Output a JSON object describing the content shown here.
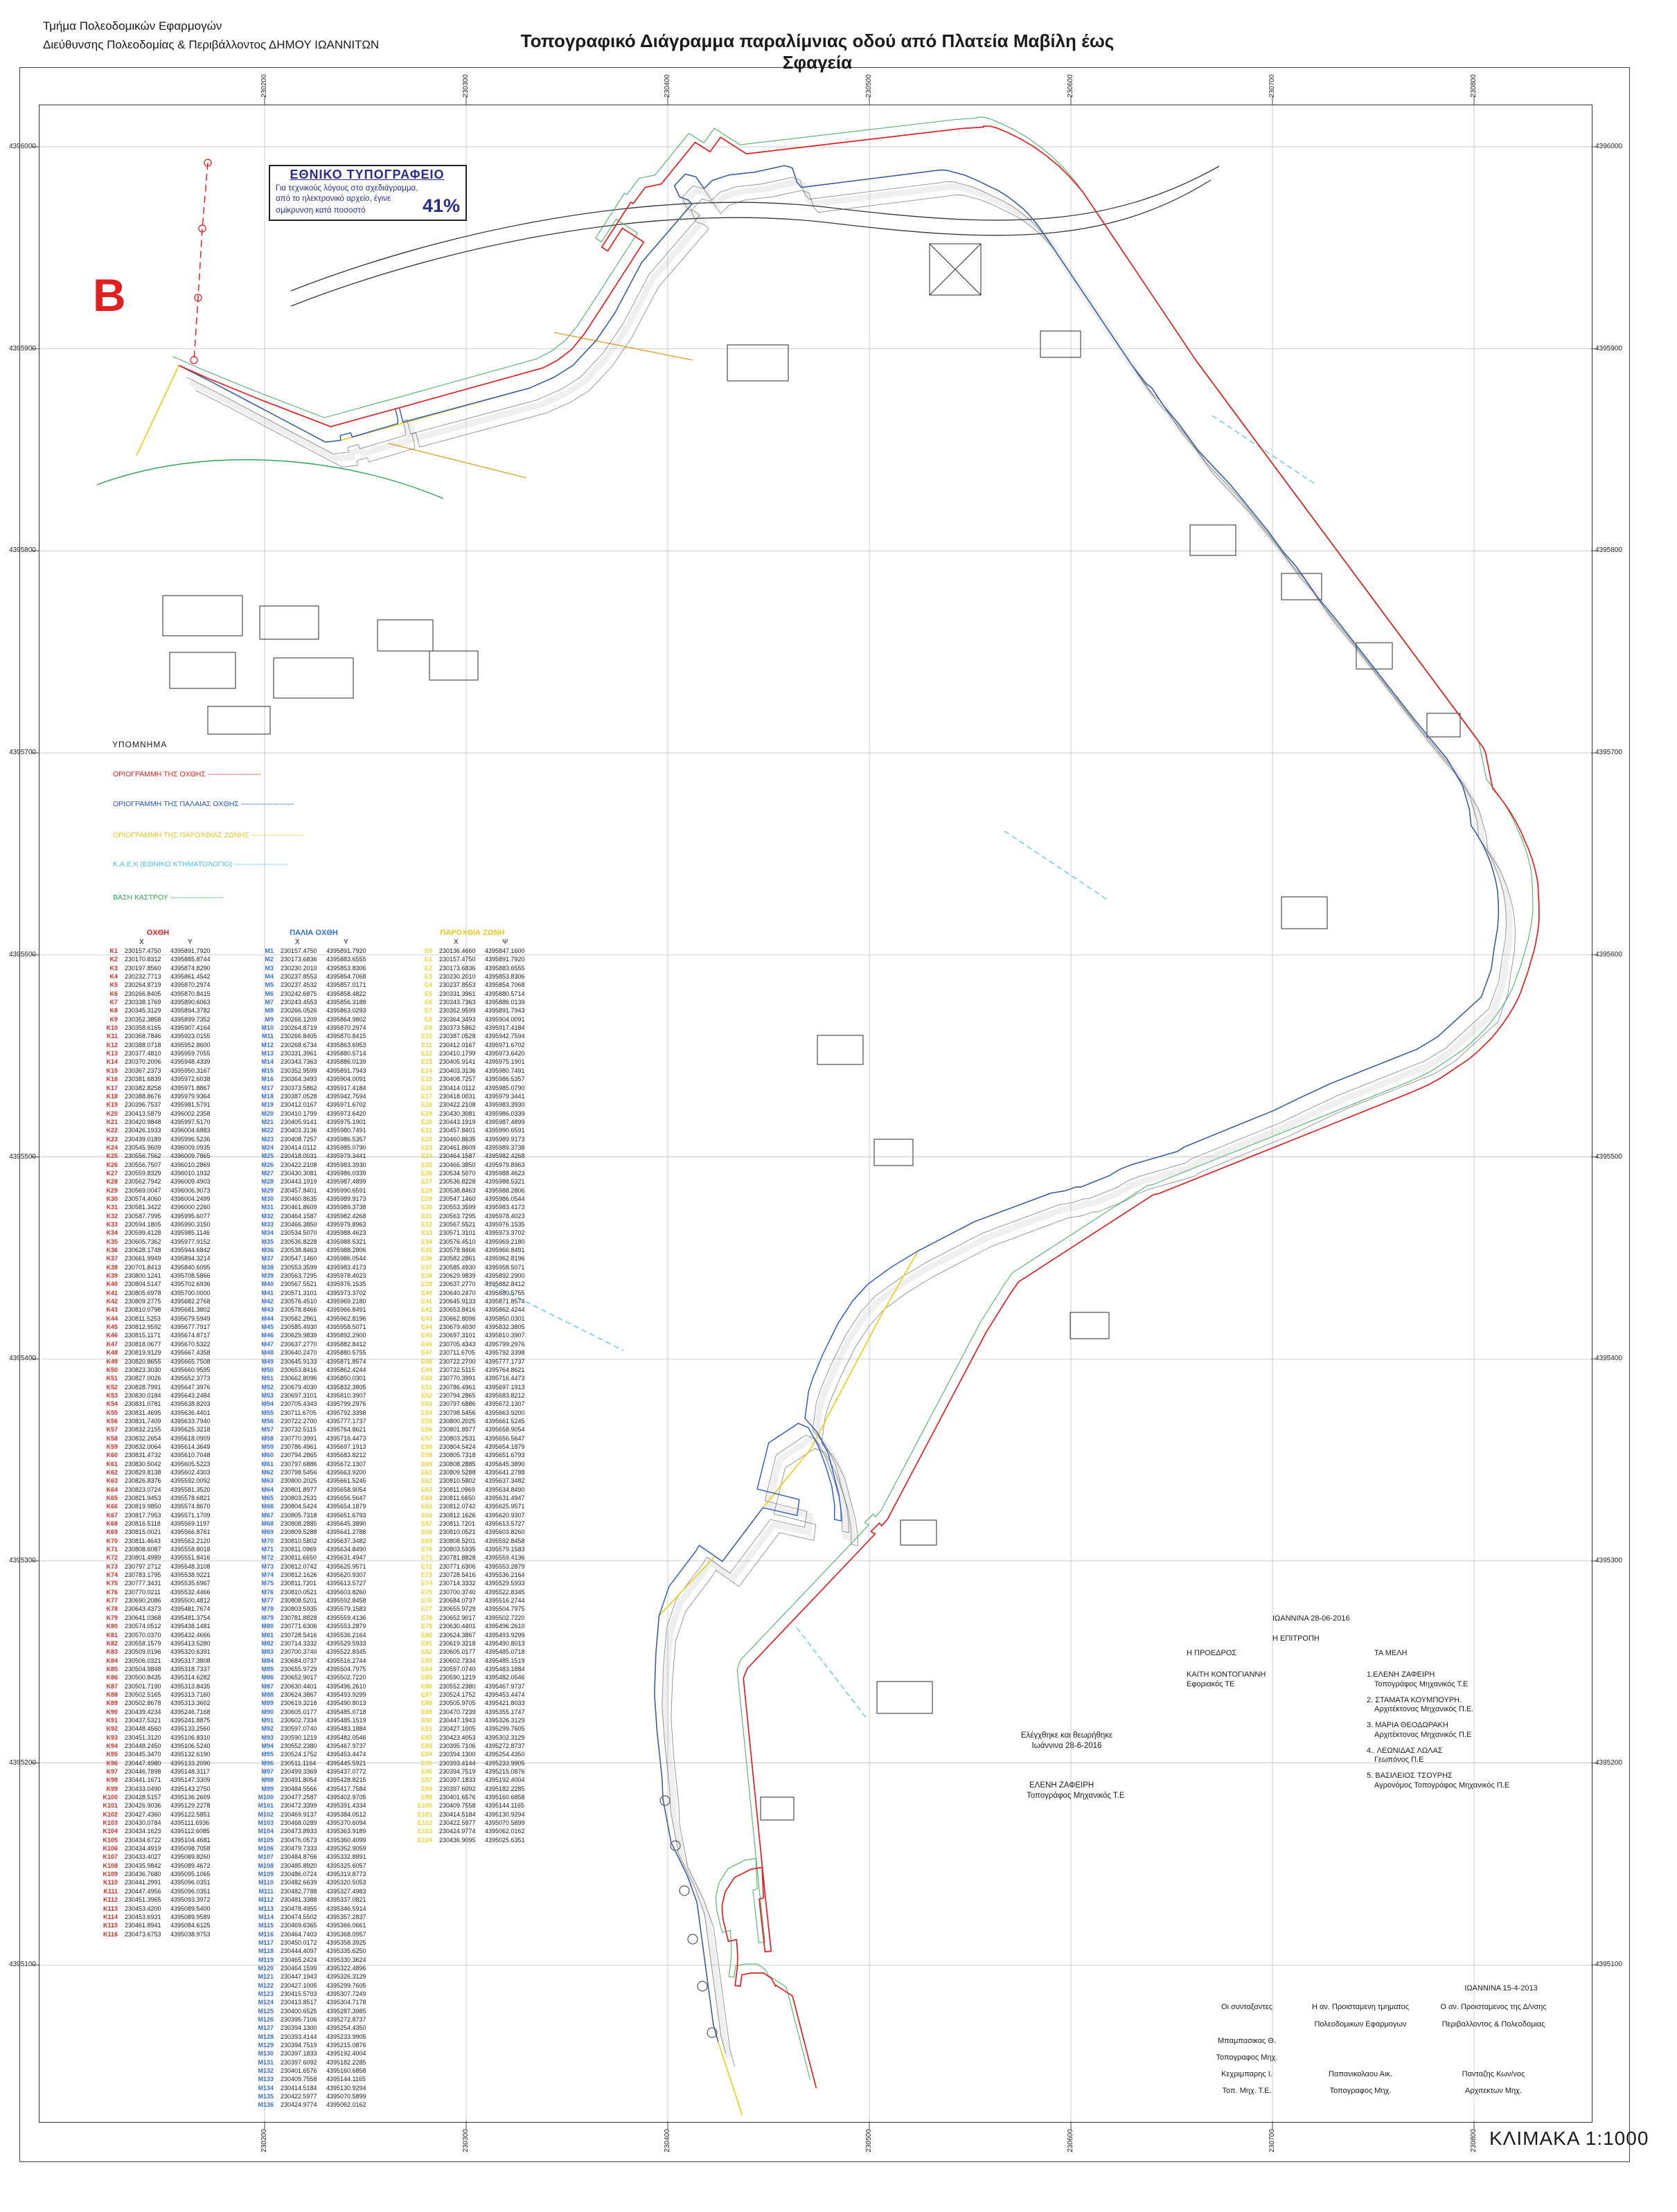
{
  "page": {
    "header_line1": "Τμήμα Πολεοδομικών Εφαρμογών",
    "header_line2": "Διεύθυνσης Πολεοδομίας & Περιβάλλοντος ΔΗΜΟΥ ΙΩΑΝΝΙΤΩΝ",
    "title": "Τοπογραφικό Διάγραμμα παραλίμνιας οδού από Πλατεία Μαβίλη έως Σφαγεία",
    "marker": "B",
    "scale_label": "ΚΛΙΜΑΚΑ 1:1000"
  },
  "reduction_box": {
    "title": "ΕΘΝΙΚΟ ΤΥΠΟΓΡΑΦΕΙΟ",
    "line1": "Για τεχνικούς λόγους στο σχεδιάγραμμα,",
    "line2": "από το ηλεκτρονικό αρχείο, έγινε",
    "line3": "σμίκρυνση κατά ποσοστό",
    "value": "41%"
  },
  "legend": {
    "title": "ΥΠΟΜΝΗΜΑ",
    "items": [
      {
        "label": "ΟΡΙΟΓΡΑΜΜΗ ΤΗΣ ΟΧΘΗΣ",
        "color": "#e02020"
      },
      {
        "label": "ΟΡΙΟΓΡΑΜΜΗ ΤΗΣ ΠΑΛΑΙΑΣ ΟΧΘΗΣ",
        "color": "#2456c8"
      },
      {
        "label": "ΟΡΙΟΓΡΑΜΜΗ ΤΗΣ ΠΑΡΟΧΘΙΑΣ ΖΩΝΗΣ",
        "color": "#e8c51d"
      },
      {
        "label": "Κ.Α.Ε.Κ (ΕΘΝΙΚΟ ΚΤΗΜΑΤΟΛΟΓΙΟ)",
        "color": "#45c0ee"
      },
      {
        "label": "ΒΑΣΗ ΚΑΣΤΡΟΥ",
        "color": "#2ea44f"
      }
    ]
  },
  "grid": {
    "x_labels": [
      "230200",
      "230300",
      "230400",
      "230500",
      "230600",
      "230700",
      "230800"
    ],
    "y_labels": [
      "4396000",
      "4395900",
      "4395800",
      "4395700",
      "4395600",
      "4395500",
      "4395400",
      "4395300",
      "4395200",
      "4395100"
    ]
  },
  "tables": [
    {
      "title": "ΟΧΘΗ",
      "x_header": "X",
      "y_header": "Y",
      "title_color": "#e02020",
      "label_color": "#d03028",
      "line_color": "#e02020",
      "rows": [
        "K1 230157.4750 4395891.7920",
        "K2 230170.8312 4395885.8744",
        "K3 230197.8560 4395874.8290",
        "K4 230232.7713 4395861.4542",
        "K5 230264.8719 4395870.2974",
        "K6 230266.8405 4395870.8415",
        "K7 230338.1769 4395890.6063",
        "K8 230345.3129 4395894.3782",
        "K9 230352.3858 4395899.7352",
        "K10 230358.6165 4395907.4164",
        "K11 230368.7846 4395923.0155",
        "K12 230388.0718 4395952.8600",
        "K13 230377.4810 4395959.7055",
        "K14 230370.2006 4395948.4339",
        "K15 230367.2373 4395950.3167",
        "K16 230381.6839 4395972.6038",
        "K17 230382.8258 4395971.8867",
        "K18 230388.8676 4395979.9364",
        "K19 230396.7537 4395981.5791",
        "K20 230413.5879 4396002.2358",
        "K21 230420.9848 4395997.5170",
        "K22 230426.1933 4396004.6883",
        "K23 230439.0189 4395996.5236",
        "K24 230545.9609 4396009.0935",
        "K25 230556.7562 4396009.7865",
        "K26 230556.7507 4396010.2869",
        "K27 230559.8329 4396010.1932",
        "K28 230562.7942 4396009.4903",
        "K29 230569.0047 4396006.9073",
        "K30 230574.4060 4396004.2499",
        "K31 230581.3422 4396000.2260",
        "K32 230587.7995 4395995.6077",
        "K33 230594.1805 4395990.3150",
        "K34 230599.4128 4395985.1146",
        "K35 230605.7362 4395977.9152",
        "K36 230628.1748 4395944.6842",
        "K37 230661.9949 4395894.3214",
        "K38 230701.8413 4395840.6095",
        "K39 230800.1241 4395708.5866",
        "K40 230804.5147 4395702.6936",
        "K41 230805.6978 4395700.0000",
        "K42 230809.2775 4395682.2768",
        "K43 230810.0798 4395681.3802",
        "K44 230811.5253 4395679.5949",
        "K45 230812.9592 4395677.7917",
        "K46 230815.1171 4395674.8717",
        "K47 230818.0677 4395670.5322",
        "K48 230819.9129 4395667.4358",
        "K49 230820.8655 4395665.7508",
        "K50 230823.3030 4395660.9595",
        "K51 230827.0026 4395652.3773",
        "K52 230828.7991 4395647.3976",
        "K53 230830.0184 4395643.2484",
        "K54 230831.0781 4395638.8203",
        "K55 230831.4695 4395636.4401",
        "K56 230831.7409 4395633.7940",
        "K57 230832.2155 4395625.3218",
        "K58 230832.2654 4395618.0909",
        "K59 230832.0064 4395614.3649",
        "K60 230831.4732 4395610.7048",
        "K61 230830.5042 4395605.5223",
        "K62 230829.8138 4395602.4303",
        "K63 230826.8376 4395592.0092",
        "K64 230823.0724 4395581.3520",
        "K65 230821.9453 4395578.6821",
        "K66 230819.9850 4395574.8670",
        "K67 230817.7953 4395571.1709",
        "K68 230816.5118 4395569.1197",
        "K69 230815.0021 4395566.8761",
        "K70 230811.4643 4395562.2120",
        "K71 230808.6087 4395558.8018",
        "K72 230801.4989 4395551.8416",
        "K73 230797.2712 4395548.3108",
        "K74 230783.1795 4395538.9221",
        "K75 230777.3431 4395535.6967",
        "K76 230770.0211 4395532.4466",
        "K77 230690.2086 4395500.4812",
        "K78 230643.4373 4395481.7674",
        "K79 230641.0368 4395481.3754",
        "K80 230574.0512 4395438.1481",
        "K81 230570.0370 4395432.4666",
        "K82 230558.1579 4395413.5280",
        "K83 230509.0196 4395320.6391",
        "K84 230506.0321 4395317.3808",
        "K85 230504.9848 4395318.7337",
        "K86 230500.8435 4395314.6282",
        "K87 230501.7190 4395313.8435",
        "K88 230502.5165 4395313.7160",
        "K89 230502.8678 4395313.3602",
        "K90 230439.4234 4395246.7168",
        "K91 230437.5321 4395241.8875",
        "K92 230448.4560 4395133.2560",
        "K93 230451.3120 4395106.8310",
        "K94 230448.2450 4395106.5240",
        "K95 230445.3470 4395132.6190",
        "K96 230447.4980 4395133.2090",
        "K97 230446.7898 4395148.3117",
        "K98 230441.1671 4395147.3309",
        "K99 230433.0490 4395143.2750",
        "K100 230428.5157 4395136.2609",
        "K101 230426.9036 4395129.2278",
        "K102 230427.4360 4395122.5851",
        "K103 230430.0784 4395111.6936",
        "K104 230434.1623 4395112.6085",
        "K105 230434.6722 4395104.4681",
        "K106 230434.4919 4395098.7058",
        "K107 230433.4027 4395089.8260",
        "K108 230435.9842 4395089.4672",
        "K109 230436.7680 4395095.1065",
        "K110 230441.2991 4395096.0351",
        "K111 230447.4956 4395096.0351",
        "K112 230451.3965 4395093.3972",
        "K113 230453.4200 4395089.5400",
        "K114 230453.6931 4395089.9589",
        "K115 230461.8941 4395084.6125",
        "K116 230473.6753 4395038.9753"
      ]
    },
    {
      "title": "ΠΑΛΙΑ ΟΧΘΗ",
      "x_header": "X",
      "y_header": "Y",
      "title_color": "#2e6bd0",
      "label_color": "#3a6fc8",
      "line_color": "#2456c8",
      "rows": [
        "M1 230157.4750 4395891.7920",
        "M2 230173.6836 4395883.6555",
        "M3 230230.2010 4395853.8306",
        "M4 230237.8553 4395854.7068",
        "M5 230237.4532 4395857.0171",
        "M6 230242.6875 4395858.4822",
        "M7 230243.4553 4395856.3188",
        "M8 230266.0526 4395863.0293",
        "M9 230266.1209 4395864.9802",
        "M10 230264.8719 4395870.2974",
        "M11 230266.8405 4395870.8415",
        "M12 230268.6734 4395863.6953",
        "M13 230331.3961 4395880.5714",
        "M14 230343.7363 4395886.0139",
        "M15 230352.9599 4395891.7943",
        "M16 230364.3493 4395904.0091",
        "M17 230373.5862 4395917.4184",
        "M18 230387.0528 4395942.7594",
        "M19 230412.0167 4395971.6702",
        "M20 230410.1799 4395973.6420",
        "M21 230405.9141 4395975.1901",
        "M22 230403.3136 4395980.7491",
        "M23 230408.7257 4395986.5357",
        "M24 230414.0112 4395985.0790",
        "M25 230418.0031 4395979.3441",
        "M26 230422.2108 4395983.3930",
        "M27 230430.3081 4395986.0339",
        "M28 230443.1919 4395987.4899",
        "M29 230457.8401 4395990.6591",
        "M30 230460.8635 4395989.9173",
        "M31 230461.8609 4395989.3738",
        "M32 230464.1587 4395982.4268",
        "M33 230466.3850 4395979.8963",
        "M34 230534.5070 4395988.4623",
        "M35 230536.8228 4395988.5321",
        "M36 230538.8463 4395988.2806",
        "M37 230547.1460 4395986.0544",
        "M38 230553.3599 4395983.4173",
        "M39 230563.7295 4395978.4023",
        "M40 230567.5521 4395976.1535",
        "M41 230571.3101 4395973.3702",
        "M42 230576.4510 4395969.2180",
        "M43 230578.8466 4395966.8491",
        "M44 230582.2861 4395962.8196",
        "M45 230585.4930 4395958.5071",
        "M46 230629.9839 4395892.2900",
        "M47 230637.2770 4395882.8412",
        "M48 230640.2470 4395880.5755",
        "M49 230645.9133 4395871.8574",
        "M50 230653.8416 4395862.4244",
        "M51 230662.8096 4395850.0301",
        "M52 230679.4030 4395832.3805",
        "M53 230697.3101 4395810.3907",
        "M54 230705.4343 4395799.2976",
        "M55 230711.6705 4395792.3398",
        "M56 230722.2700 4395777.1737",
        "M57 230732.5115 4395764.8621",
        "M58 230770.3991 4395716.4473",
        "M59 230786.4961 4395697.1913",
        "M60 230794.2865 4395683.8212",
        "M61 230797.6886 4395672.1307",
        "M62 230798.5456 4395663.9200",
        "M63 230800.2025 4395661.5245",
        "M64 230801.8977 4395658.9054",
        "M65 230803.2531 4395656.5647",
        "M66 230804.5424 4395654.1879",
        "M67 230805.7318 4395651.6793",
        "M68 230808.2885 4395645.3890",
        "M69 230809.5288 4395641.2788",
        "M70 230810.5802 4395637.3482",
        "M71 230811.0969 4395634.8490",
        "M72 230811.6650 4395631.4947",
        "M73 230812.0742 4395625.9571",
        "M74 230812.1626 4395620.9307",
        "M75 230811.7201 4395613.5727",
        "M76 230810.0521 4395603.8260",
        "M77 230808.5201 4395592.8458",
        "M78 230803.5935 4395579.1583",
        "M79 230781.8828 4395559.4136",
        "M80 230771.6306 4395553.2879",
        "M81 230728.5416 4395536.2164",
        "M82 230714.3332 4395529.5933",
        "M83 230700.3740 4395522.8345",
        "M84 230684.0737 4395516.2744",
        "M85 230655.9729 4395504.7975",
        "M86 230652.9017 4395502.7220",
        "M87 230630.4401 4395496.2610",
        "M88 230624.3867 4395493.9299",
        "M89 230619.3218 4395490.8013",
        "M90 230605.0177 4395485.0718",
        "M91 230602.7334 4395485.1519",
        "M92 230597.0740 4395483.1884",
        "M93 230590.1219 4395482.0546",
        "M94 230552.2380 4395467.9737",
        "M95 230524.1752 4395453.4474",
        "M96 230511.1164 4395445.5921",
        "M97 230499.3369 4395437.0772",
        "M98 230491.8054 4395428.8215",
        "M99 230484.5566 4395417.7584",
        "M100 230477.2587 4395402.9705",
        "M101 230472.3399 4395391.4334",
        "M102 230469.9137 4395384.0512",
        "M103 230468.0289 4395370.6094",
        "M104 230473.8933 4395363.9189",
        "M105 230476.0573 4395360.4099",
        "M106 230479.7333 4395352.9059",
        "M107 230484.8766 4395332.8891",
        "M108 230485.8920 4395325.6057",
        "M109 230486.0724 4395319.8773",
        "M110 230482.6639 4395320.5053",
        "M111 230482.7788 4395327.4983",
        "M112 230481.3388 4395337.0821",
        "M113 230478.4955 4395346.5914",
        "M114 230474.5502 4395357.2837",
        "M115 230469.6365 4395366.0661",
        "M116 230464.7403 4395368.0957",
        "M117 230450.0172 4395358.3925",
        "M118 230444.4097 4395335.6250",
        "M119 230465.2424 4395330.3624",
        "M120 230464.1599 4395322.4896",
        "M121 230447.1943 4395326.3129",
        "M122 230427.1005 4395299.7605",
        "M123 230415.5703 4395307.7249",
        "M124 230413.8517 4395304.7178",
        "M125 230400.6525 4395287.3985",
        "M126 230395.7106 4395272.8737",
        "M127 230394.1300 4395254.4350",
        "M128 230393.4144 4395233.9905",
        "M129 230394.7519 4395215.0876",
        "M130 230397.1833 4395192.4004",
        "M131 230397.6092 4395182.2285",
        "M132 230401.6576 4395160.6858",
        "M133 230409.7558 4395144.1165",
        "M134 230414.5184 4395130.9294",
        "M135 230422.5977 4395070.5899",
        "M136 230424.9774 4395062.0162"
      ]
    },
    {
      "title": "ΠΑΡΟΧΘΙΑ ΖΩΝΗ",
      "x_header": "X",
      "y_header": "Ψ",
      "title_color": "#e3cb1a",
      "label_color": "#e8d435",
      "line_color": "#e8d22a",
      "rows": [
        "Ε0 230136.4660 4395847.1600",
        "Ε1 230157.4750 4395891.7920",
        "Ε2 230173.6836 4395883.6555",
        "Ε3 230230.2010 4395853.8306",
        "Ε4 230237.8553 4395854.7068",
        "Ε5 230331.3961 4395880.5714",
        "Ε6 230343.7363 4395886.0139",
        "Ε7 230352.9599 4395891.7943",
        "Ε8 230364.3493 4395904.0091",
        "Ε9 230373.5862 4395917.4184",
        "Ε10 230387.0528 4395942.7594",
        "Ε11 230412.0167 4395971.6702",
        "Ε12 230410.1799 4395973.6420",
        "Ε13 230405.9141 4395975.1901",
        "Ε14 230403.3136 4395980.7491",
        "Ε15 230408.7257 4395986.5357",
        "Ε16 230414.0112 4395985.0790",
        "Ε17 230418.0031 4395979.3441",
        "Ε18 230422.2108 4395983.3930",
        "Ε19 230430.3081 4395986.0339",
        "Ε20 230443.1919 4395987.4899",
        "Ε21 230457.8401 4395990.6591",
        "Ε22 230460.8635 4395989.9173",
        "Ε23 230461.8609 4395989.3738",
        "Ε24 230464.1587 4395982.4268",
        "Ε25 230466.3850 4395979.8963",
        "Ε26 230534.5070 4395988.4623",
        "Ε27 230536.8228 4395988.5321",
        "Ε28 230538.8463 4395988.2806",
        "Ε29 230547.1460 4395986.0544",
        "Ε30 230553.3599 4395983.4173",
        "Ε31 230563.7295 4395978.4023",
        "Ε32 230567.5521 4395976.1535",
        "Ε33 230571.3101 4395973.3702",
        "Ε34 230576.4510 4395969.2180",
        "Ε35 230578.8466 4395966.8491",
        "Ε36 230582.2861 4395962.8196",
        "Ε37 230585.4930 4395958.5071",
        "Ε38 230629.9839 4395892.2900",
        "Ε39 230637.2770 4395882.8412",
        "Ε40 230640.2470 4395880.5755",
        "Ε41 230645.9133 4395871.8574",
        "Ε42 230653.8416 4395862.4244",
        "Ε43 230662.8096 4395850.0301",
        "Ε44 230679.4030 4395832.3805",
        "Ε45 230697.3101 4395810.3907",
        "Ε46 230705.4343 4395799.2976",
        "Ε47 230711.6705 4395792.3398",
        "Ε48 230722.2700 4395777.1737",
        "Ε49 230732.5115 4395764.8621",
        "Ε50 230770.3991 4395716.4473",
        "Ε51 230786.4961 4395697.1913",
        "Ε52 230794.2865 4395683.8212",
        "Ε53 230797.6886 4395672.1307",
        "Ε54 230798.5456 4395663.9200",
        "Ε55 230800.2025 4395661.5245",
        "Ε56 230801.8977 4395658.9054",
        "Ε57 230803.2531 4395656.5647",
        "Ε58 230804.5424 4395654.1879",
        "Ε59 230805.7318 4395651.6793",
        "Ε60 230808.2885 4395645.3890",
        "Ε61 230809.5288 4395641.2788",
        "Ε62 230810.5802 4395637.3482",
        "Ε63 230811.0969 4395634.8490",
        "Ε64 230811.6650 4395631.4947",
        "Ε65 230812.0742 4395625.9571",
        "Ε66 230812.1626 4395620.9307",
        "Ε67 230811.7201 4395613.5727",
        "Ε68 230810.0521 4395603.8260",
        "Ε69 230808.5201 4395592.8458",
        "Ε70 230803.5935 4395579.1583",
        "Ε71 230781.8828 4395559.4136",
        "Ε72 230771.6306 4395553.2879",
        "Ε73 230728.5416 4395536.2164",
        "Ε74 230714.3332 4395529.5933",
        "Ε75 230700.3740 4395522.8345",
        "Ε76 230684.0737 4395516.2744",
        "Ε77 230655.9729 4395504.7975",
        "Ε78 230652.9017 4395502.7220",
        "Ε79 230630.4401 4395496.2610",
        "Ε80 230624.3867 4395493.9299",
        "Ε81 230619.3218 4395490.8013",
        "Ε82 230605.0177 4395485.0718",
        "Ε83 230602.7334 4395485.1519",
        "Ε84 230597.0740 4395483.1884",
        "Ε85 230590.1219 4395482.0546",
        "Ε86 230552.2380 4395467.9737",
        "Ε87 230524.1752 4395453.4474",
        "Ε88 230505.9705 4395421.8033",
        "Ε89 230470.7239 4395355.1747",
        "Ε90 230447.1943 4395326.3129",
        "Ε91 230427.1005 4395299.7605",
        "Ε92 230423.4053 4395302.3129",
        "Ε93 230395.7106 4395272.8737",
        "Ε94 230394.1300 4395254.4350",
        "Ε95 230393.4144 4395233.9905",
        "Ε96 230394.7519 4395215.0876",
        "Ε97 230397.1833 4395192.4004",
        "Ε98 230397.6092 4395182.2285",
        "Ε99 230401.6576 4395160.6858",
        "Ε100 230409.7558 4395144.1165",
        "Ε101 230414.5184 4395130.9294",
        "Ε102 230422.5977 4395070.5899",
        "Ε103 230424.9774 4395062.0162",
        "Ε104 230436.9095 4395025.6351"
      ]
    }
  ],
  "committee": {
    "date": "ΙΩΑΝΝΙΝΑ  28-06-2016",
    "heading": "Η ΕΠΙΤΡΟΠΗ",
    "president_title": "Η  ΠΡΟΕΔΡΟΣ",
    "president_name": "ΚΑΙΤΗ ΚΟΝΤΟΓΙΑΝΝΗ",
    "president_role": "Εφοριακός ΤΕ",
    "members_title": "ΤΑ  ΜΕΛΗ",
    "members": [
      {
        "name": "1.ΕΛΕΝΗ ΖΑΦΕΙΡΗ",
        "role": "Τοπογράφος Μηχανικός Τ.Ε"
      },
      {
        "name": "2. ΣΤΑΜΑΤΑ ΚΟΥΜΠΟΥΡΗ.",
        "role": "Αρχιτέκτονας Μηχανικός Π.Ε."
      },
      {
        "name": "3. ΜΑΡΙΑ ΘΕΟΔΩΡΑΚΗ",
        "role": "Αρχιτέκτονας Μηχανικός Π.Ε"
      },
      {
        "name": "4.. ΛΕΩΝΙΔΑΣ ΛΩΛΑΣ",
        "role": "Γεωπόνος Π.Ε"
      },
      {
        "name": "5. ΒΑΣΙΛΕΙΟΣ ΤΣΟΥΡΗΣ",
        "role": "Αγρονόμος Τοπογράφος Μηχανικός Π.Ε"
      }
    ]
  },
  "checked_block": {
    "line1": "Ελέγχθηκε και θεωρήθηκε",
    "line2": "Ιωάννινα 28-6-2016",
    "name": "ΕΛΕΝΗ ΖΑΦΕΙΡΗ",
    "role": "Τοπογράφος Μηχανικός Τ.Ε"
  },
  "signoff": {
    "date": "ΙΩΑΝΝΙΝΑ  15-4-2013",
    "columns": [
      {
        "header": [
          "Οι συνταξαντες",
          ""
        ],
        "names": [
          [
            "Μπαμπασικας  Θ.",
            "Τοπογραφος Μηχ."
          ],
          [
            "Κεχριμπαρης  Ι.",
            "Τοπ. Μηχ. Τ.Ε."
          ]
        ]
      },
      {
        "header": [
          "Η αν. Προισταμενη τμηματος",
          "Πολεοδομικων  Εφαρμογων"
        ],
        "names": [
          [
            "Παπανικολαου  Αικ.",
            "Τοπογραφος  Μηχ."
          ]
        ]
      },
      {
        "header": [
          "Ο αν. Προισταμενος της Δ/νσης",
          "Περιβαλλοντος  &  Πολεοδομιας"
        ],
        "names": [
          [
            "Πανταζης  Κων/νος",
            "Αρχιτεκτων  Μηχ."
          ]
        ]
      }
    ]
  }
}
